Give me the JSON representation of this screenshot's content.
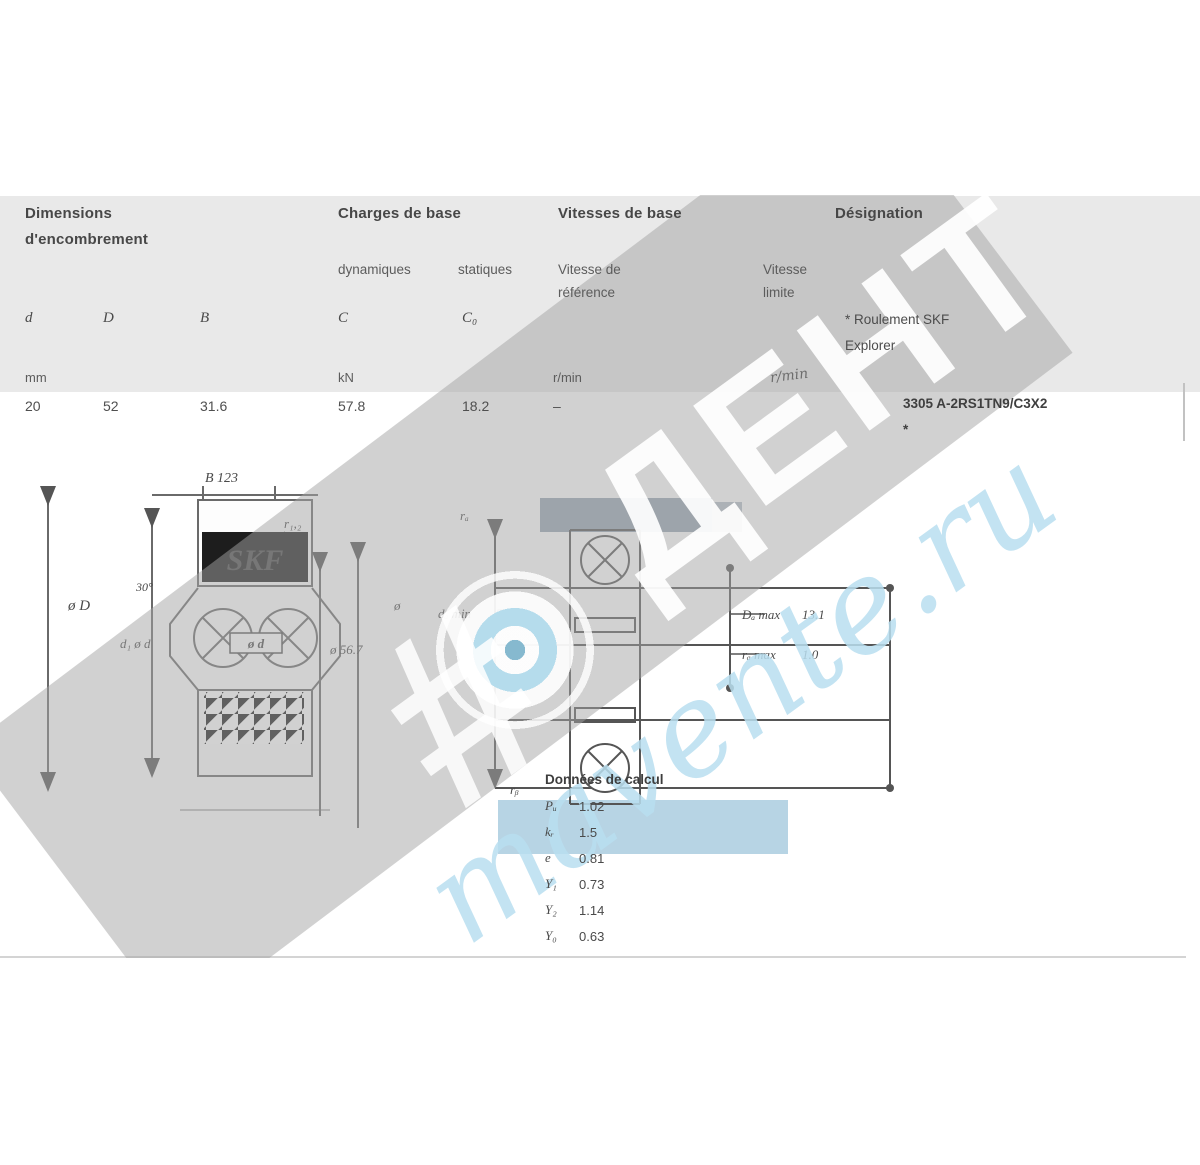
{
  "table": {
    "group_dimensions_line1": "Dimensions",
    "group_dimensions_line2": "d'encombrement",
    "group_loads": "Charges de base",
    "sub_dynamic": "dynamiques",
    "sub_static": "statiques",
    "group_speeds": "Vitesses de base",
    "sub_ref_line1": "Vitesse de",
    "sub_ref_line2": "référence",
    "sub_lim_line1": "Vitesse",
    "sub_lim_line2": "limite",
    "group_designation": "Désignation",
    "footnote_line1": "* Roulement SKF",
    "footnote_line2": "Explorer",
    "cols": {
      "d": "d",
      "D": "D",
      "B": "B",
      "C": "C",
      "C0": "C₀"
    },
    "units": {
      "mm": "mm",
      "kN": "kN",
      "rpm_ref": "r/min",
      "rpm_lim": "r/min"
    },
    "row": {
      "d": "20",
      "D": "52",
      "B": "31.6",
      "C": "57.8",
      "C0": "18.2",
      "speed_ref": "–",
      "designation": "3305 A-2RS1TN9/C3X2",
      "star": "*"
    }
  },
  "left_drawing": {
    "dim_B": "B 123",
    "dim_r12": "r₁,₂",
    "dim_oD": "ø D",
    "dim_d1_od": "d₁ ø d",
    "bore": "ø d",
    "dim_oD1": "ø 56.7",
    "dim_o2": "ø",
    "angle": "30°",
    "logo": "SKF"
  },
  "right_drawing": {
    "ra_top": "rₐ",
    "rb_bottom": "rᵦ",
    "da_label": "dₐ min",
    "da_value": "7.6",
    "Da_label": "Dₐ max",
    "Da_value": "13.1",
    "ra_label": "rₐ max",
    "ra_value": "1.0"
  },
  "calc": {
    "title": "Données de calcul",
    "items": [
      {
        "label": "Pᵤ",
        "value": "1.02"
      },
      {
        "label": "kᵣ",
        "value": "1.5"
      },
      {
        "label": "e",
        "value": "0.81"
      },
      {
        "label": "Y₁",
        "value": "0.73"
      },
      {
        "label": "Y₂",
        "value": "1.14"
      },
      {
        "label": "Y₀",
        "value": "0.63"
      }
    ]
  },
  "watermark": {
    "brand": "ДЕНТ",
    "site": "mavente.ru",
    "hash": "#"
  }
}
